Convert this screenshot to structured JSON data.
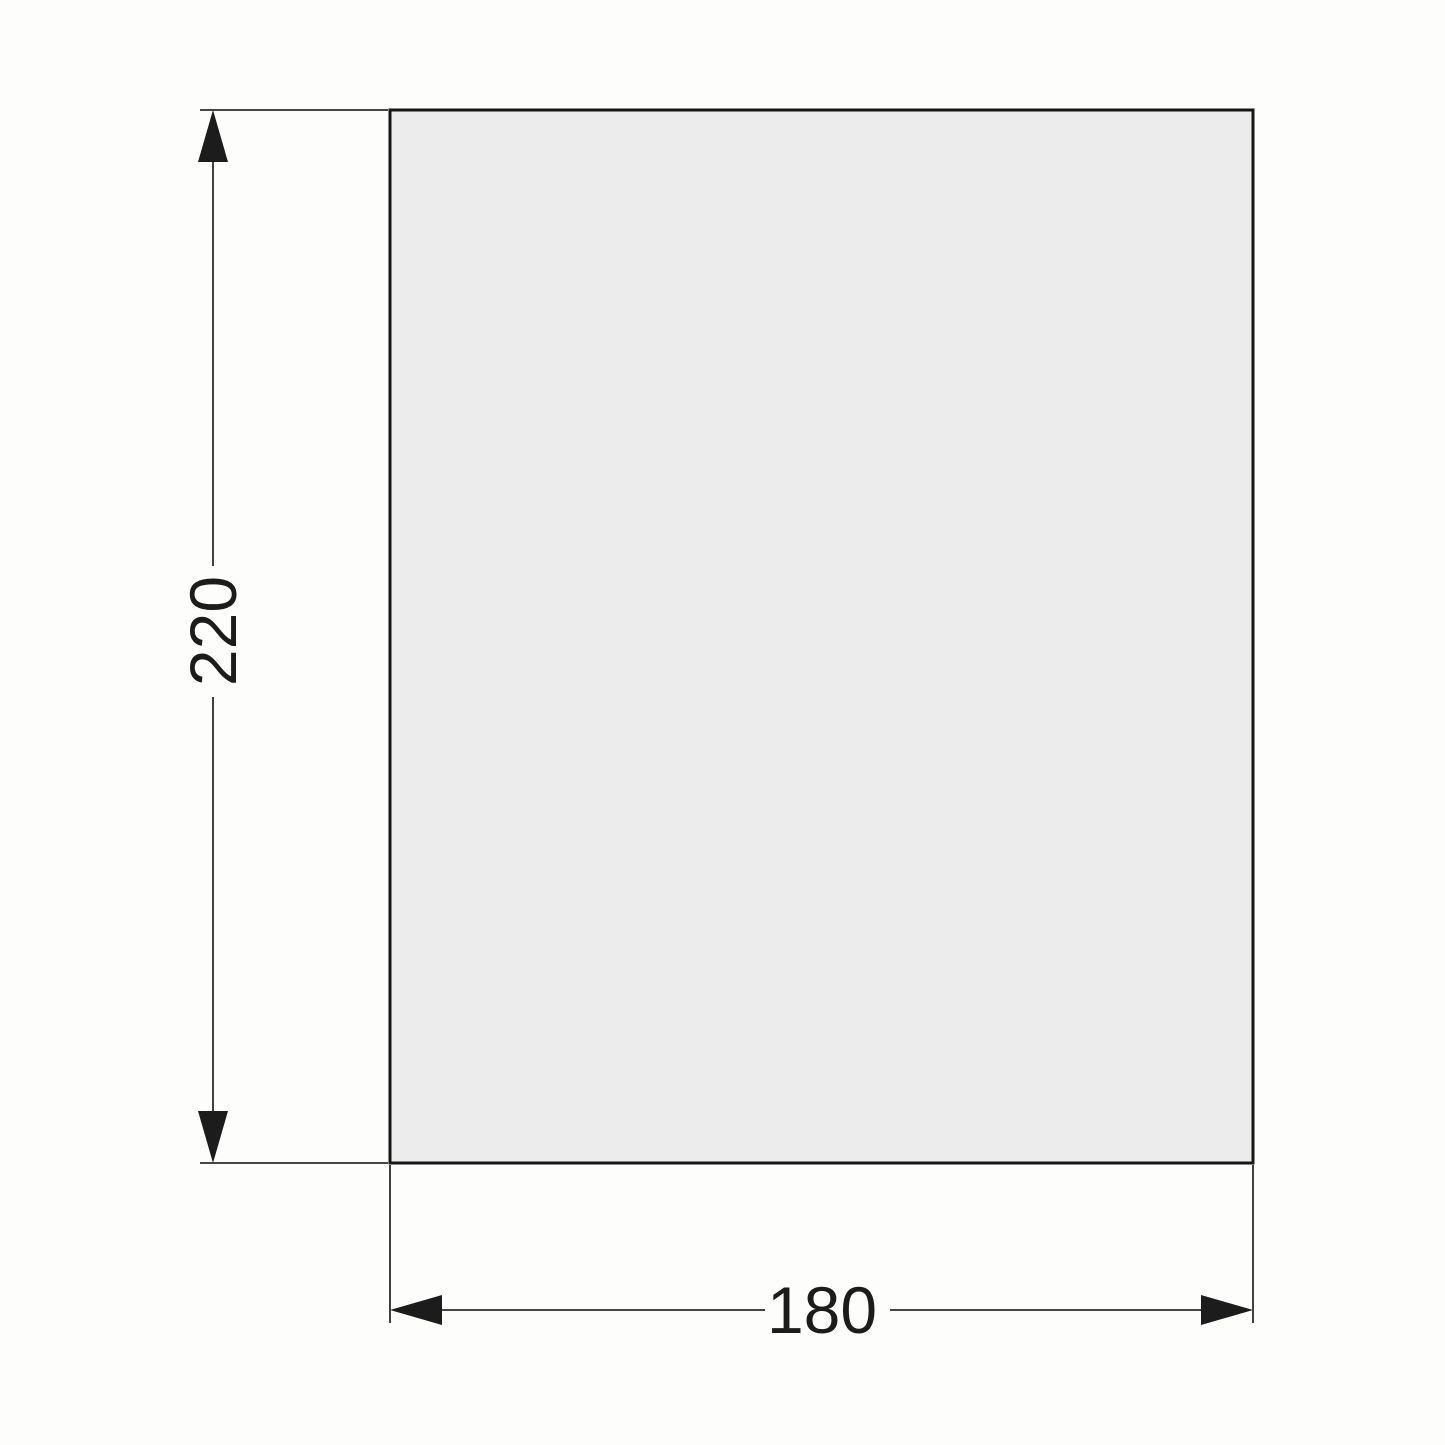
{
  "drawing": {
    "type": "dimensioned-rectangle-technical-drawing",
    "dimensions": {
      "height_label": "220",
      "width_label": "180"
    },
    "colors": {
      "background": "#fdfdfc",
      "part_fill": "#ececec",
      "part_stroke": "#161616",
      "dimension_stroke": "#2b2b2b",
      "arrow_fill": "#1c1c1c",
      "text_color": "#1c1c1c"
    }
  }
}
